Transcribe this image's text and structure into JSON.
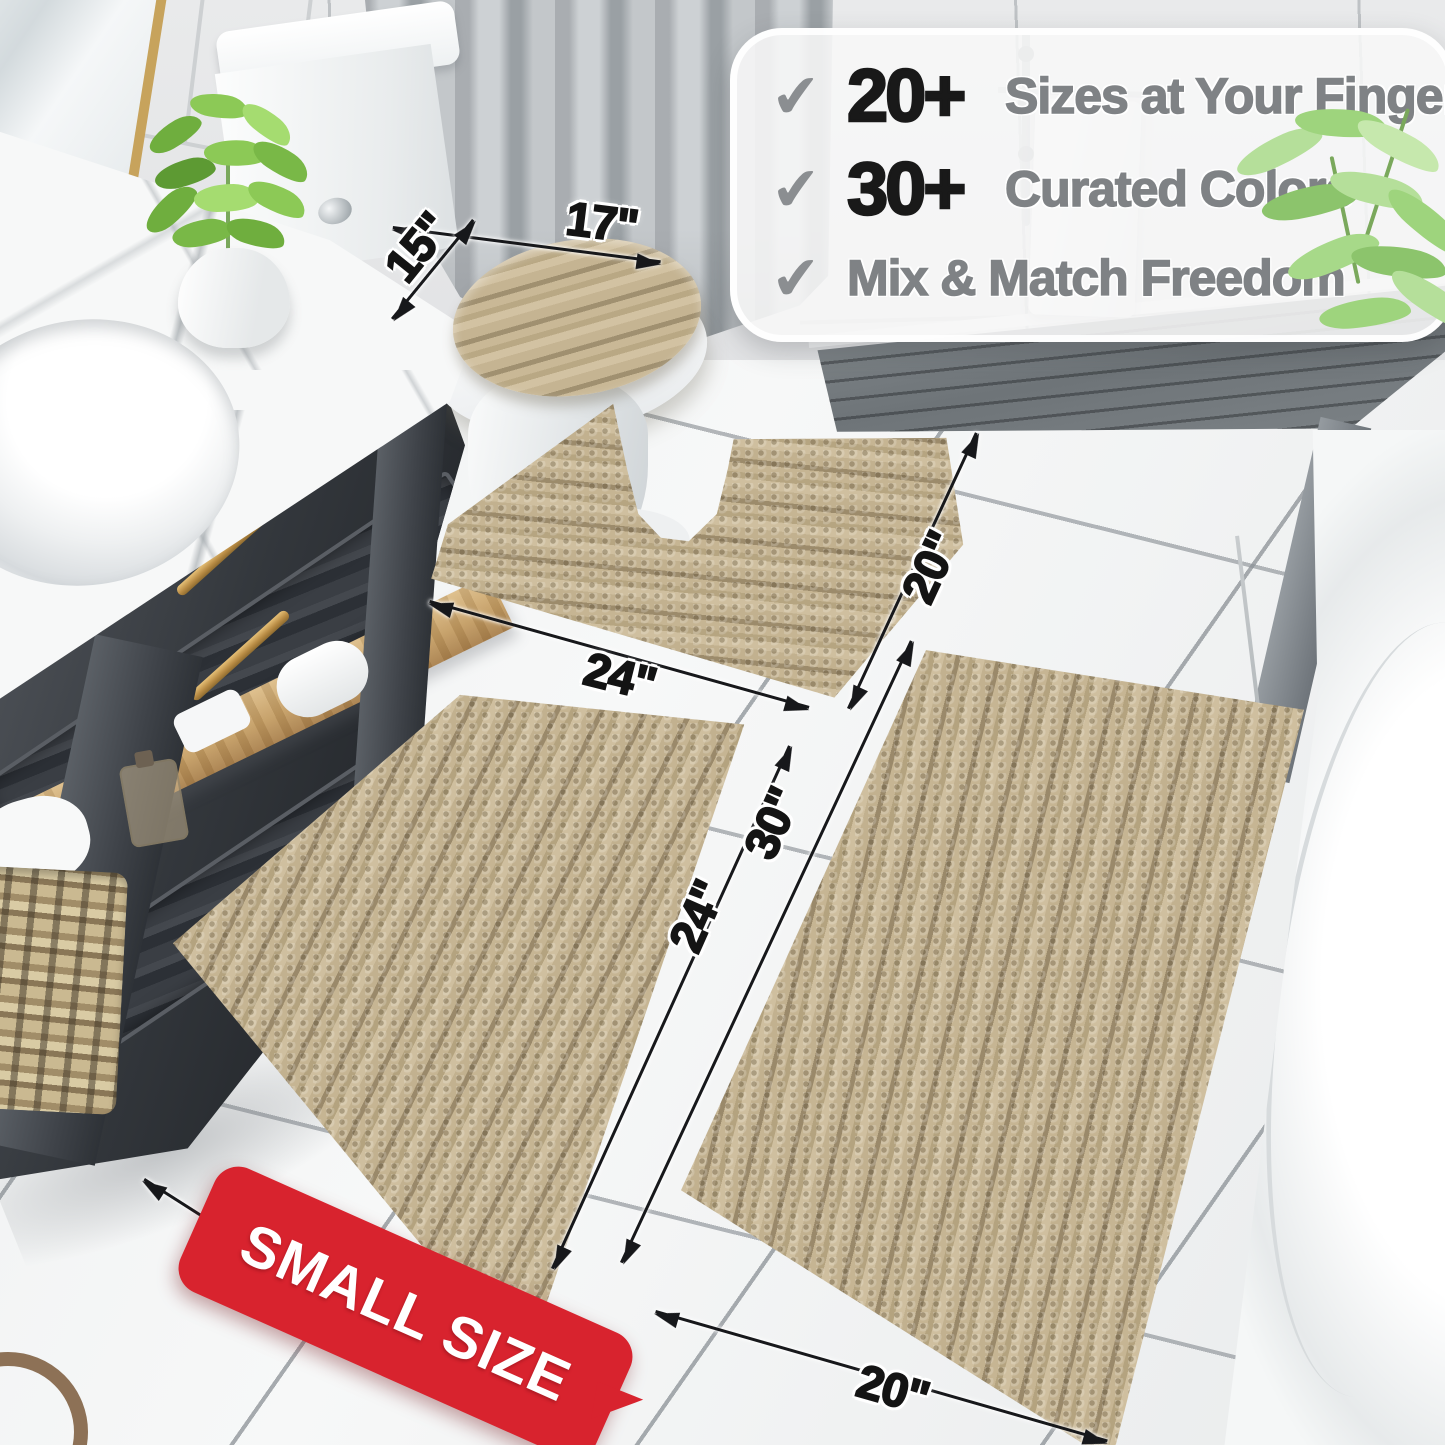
{
  "callout": {
    "checkmark": "✔",
    "features": [
      {
        "stat": "20+",
        "label": "Sizes at Your Fingertips"
      },
      {
        "stat": "30+",
        "label": "Curated Colors"
      },
      {
        "stat": "",
        "label": "Mix & Match Freedom"
      }
    ]
  },
  "dimensions": {
    "lid_width": "17\"",
    "lid_depth": "15\"",
    "contour_width": "24\"",
    "contour_depth": "20\"",
    "small_mat_width": "16\"",
    "small_mat_length": "24\"",
    "large_mat_length": "30\"",
    "large_mat_width": "20\""
  },
  "badge": {
    "text": "SMALL SIZE"
  },
  "colors": {
    "mat_beige": "#bcab88",
    "badge_red": "#d8232e",
    "dimension_ink": "#141414",
    "feature_text_gray": "#7f8285",
    "stat_black": "#191919",
    "accent_gold": "#c7a35c"
  }
}
